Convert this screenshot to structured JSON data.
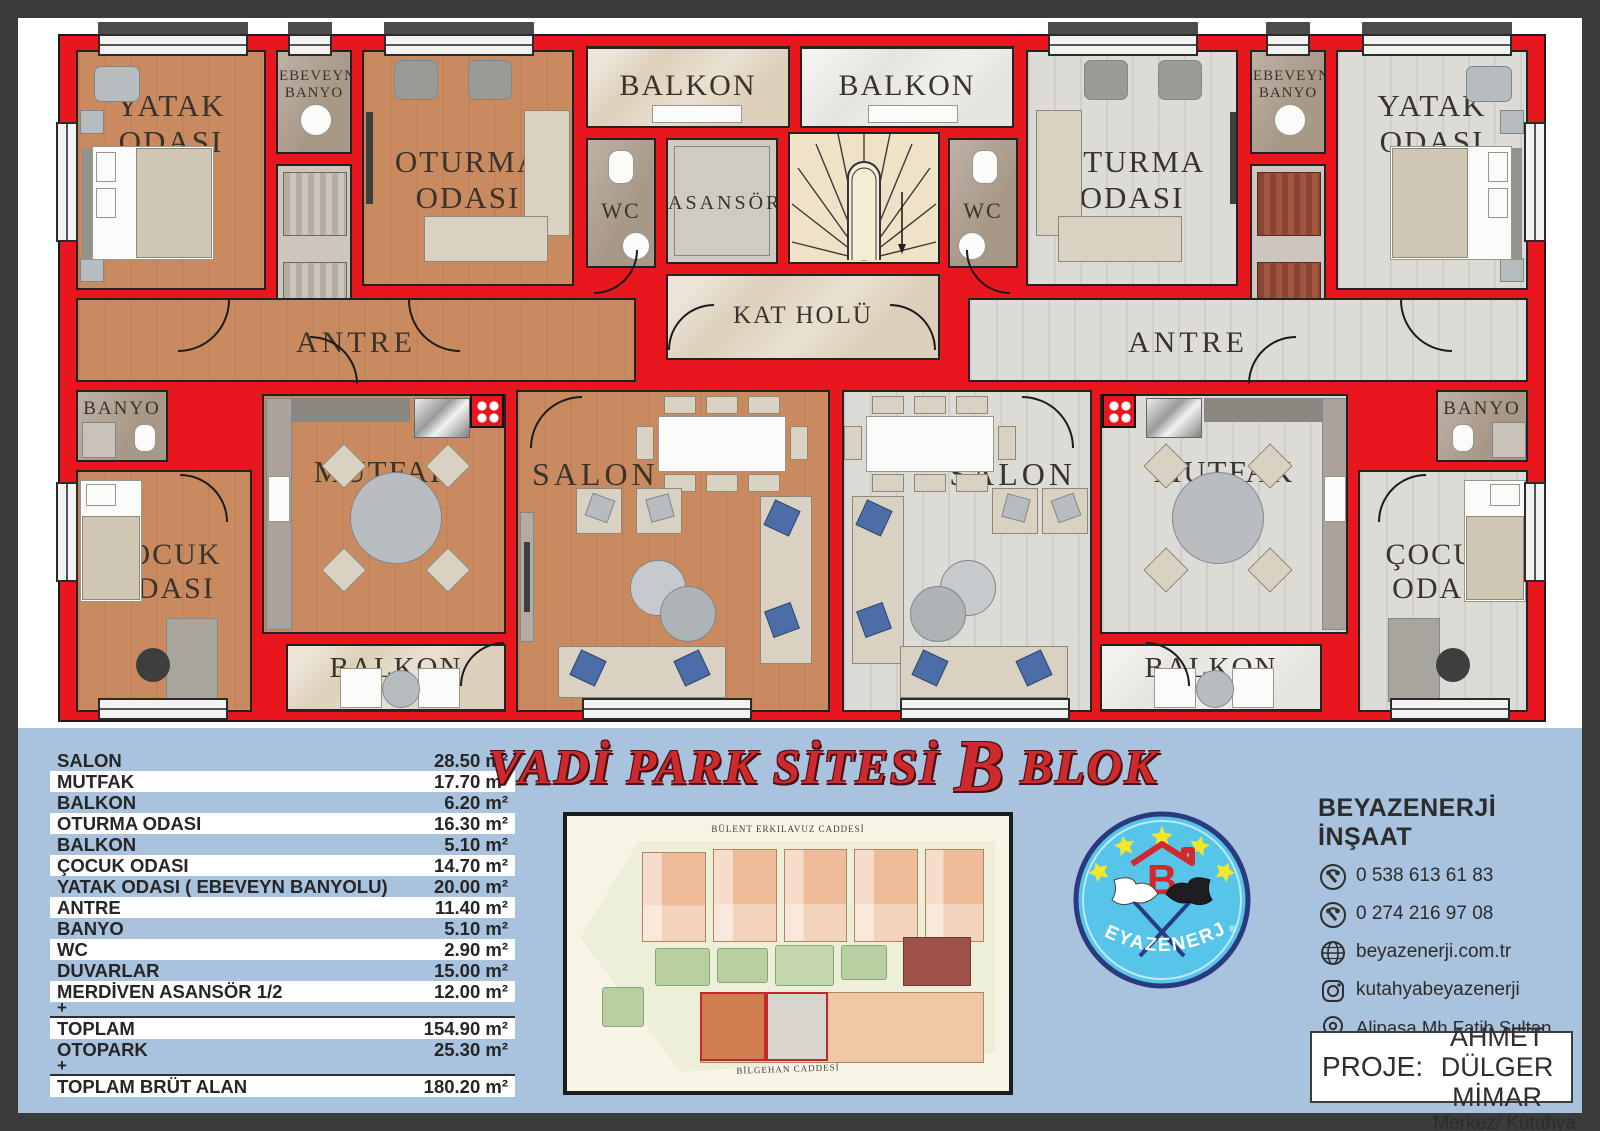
{
  "plan": {
    "labels": {
      "yatak": "YATAK ODASI",
      "ebeveyn_banyo": "EBEVEYN BANYO",
      "oturma": "OTURMA ODASI",
      "balkon": "BALKON",
      "wc": "WC",
      "asansor": "ASANSÖR",
      "kat_holu": "KAT HOLÜ",
      "antre": "ANTRE",
      "banyo": "BANYO",
      "cocuk": "ÇOCUK ODASI",
      "mutfak": "MUTFAK",
      "salon": "SALON"
    }
  },
  "area_table": {
    "rows": [
      {
        "label": "SALON",
        "value": "28.50 m²"
      },
      {
        "label": "MUTFAK",
        "value": "17.70 m²"
      },
      {
        "label": "BALKON",
        "value": "6.20 m²"
      },
      {
        "label": "OTURMA ODASI",
        "value": "16.30 m²"
      },
      {
        "label": "BALKON",
        "value": "5.10 m²"
      },
      {
        "label": "ÇOCUK ODASI",
        "value": "14.70 m²"
      },
      {
        "label": "YATAK ODASI ( EBEVEYN BANYOLU)",
        "value": "20.00 m²"
      },
      {
        "label": "ANTRE",
        "value": "11.40 m²"
      },
      {
        "label": "BANYO",
        "value": "5.10 m²"
      },
      {
        "label": "WC",
        "value": "2.90 m²"
      },
      {
        "label": "DUVARLAR",
        "value": "15.00 m²"
      },
      {
        "label": "MERDİVEN ASANSÖR 1/2",
        "value": "12.00 m²"
      },
      {
        "plus": "+"
      },
      {
        "label": "TOPLAM",
        "value": "154.90 m²"
      },
      {
        "label": "OTOPARK",
        "value": "25.30 m²"
      },
      {
        "plus": "+"
      },
      {
        "label": "TOPLAM BRÜT ALAN",
        "value": "180.20 m²"
      }
    ]
  },
  "title": {
    "part1": "VADİ PARK SİTESİ",
    "b": "B",
    "part2": "BLOK"
  },
  "site_plan": {
    "street_top": "BÜLENT ERKILAVUZ CADDESİ",
    "street_bottom": "BİLGEHAN CADDESİ"
  },
  "logo": {
    "name": "BEYAZENERJİ",
    "mark": "B",
    "registered": "®"
  },
  "contact": {
    "company": "BEYAZENERJİ İNŞAAT",
    "items": [
      {
        "icon": "phone",
        "text": "0 538 613 61 83"
      },
      {
        "icon": "phone",
        "text": "0 274 216 97 08"
      },
      {
        "icon": "globe",
        "text": "beyazenerji.com.tr"
      },
      {
        "icon": "instagram",
        "text": "kutahyabeyazenerji"
      },
      {
        "icon": "location-pin",
        "text": "Alipaşa Mh Fatih Sultan Mehmet Bulvarı Beyaz Enerji İş Merkezi No: 12-14 K:1 D:7"
      }
    ],
    "city": "Merkez/ Kütahya"
  },
  "proje": {
    "label": "PROJE:",
    "line1": "AHMET DÜLGER",
    "line2": "MİMAR"
  },
  "colors": {
    "wall_red": "#e8161d",
    "panel_blue": "#a9c2dd",
    "left_floor": "#c98a60",
    "right_floor": "#dcdbd6",
    "logo_blue": "#57c4e9",
    "title_red": "#ce2a2e",
    "frame_dark": "#3b3b3b"
  }
}
